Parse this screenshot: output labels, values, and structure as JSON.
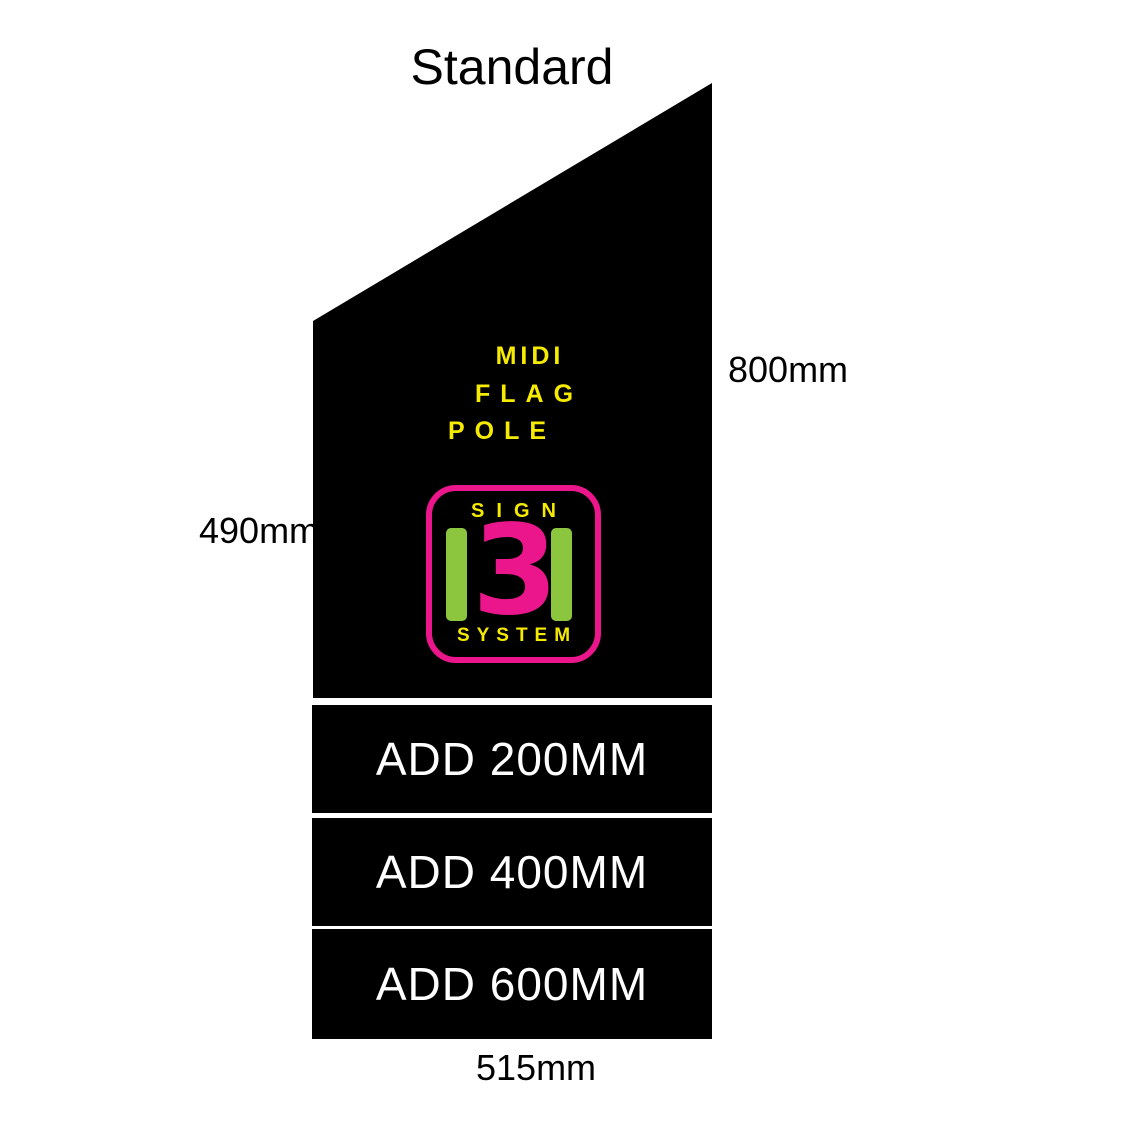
{
  "title": "Standard",
  "flag_panel": {
    "lines": [
      "MIDI",
      "FLAG",
      "POLE"
    ],
    "logo": {
      "top_word": "SIGN",
      "digit": "3",
      "bottom_word": "SYSTEM"
    },
    "badge": {
      "line1": "Cestrian",
      "line2": "Signs",
      "tagline": "One Stop Sign Service"
    }
  },
  "dimensions": {
    "right": "800mm",
    "left": "490mm",
    "bottom": "515mm"
  },
  "extensions": [
    {
      "label": "ADD 200MM"
    },
    {
      "label": "ADD 400MM"
    },
    {
      "label": "ADD 600MM"
    }
  ],
  "colors": {
    "panel_black": "#000000",
    "accent_yellow": "#F5EA00",
    "accent_pink": "#EC168C",
    "accent_green": "#8CC63F",
    "bar_text_white": "#FFFFFF",
    "badge_blue": "#A9D7F2",
    "badge_text_navy": "#15356E"
  }
}
